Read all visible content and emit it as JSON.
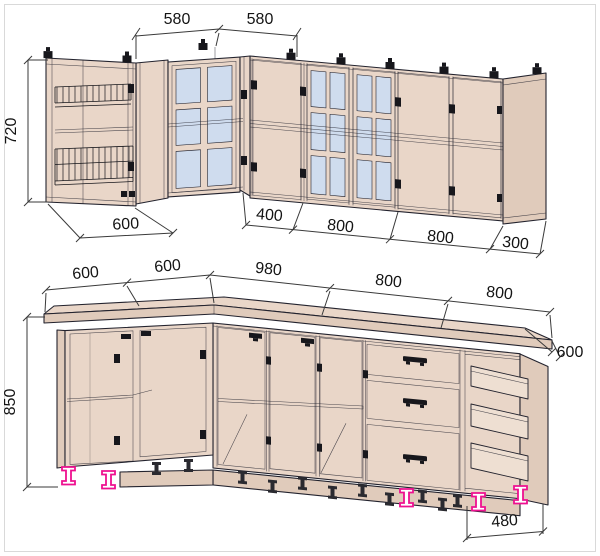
{
  "title": "L-shaped kitchen set dimensional drawing",
  "colors": {
    "background": "#ffffff",
    "cabinet": "#e9d6c8",
    "cabinet_dark": "#e0cbbb",
    "glass": "#cfdcee",
    "box": "#eedfd2",
    "line": "#23232e",
    "dim": "#3a3a3a",
    "text": "#141414",
    "fitting": "#17171c",
    "feet": "#ee1090",
    "frame": "#d9d9d9"
  },
  "dims": {
    "upper_top": [
      "580",
      "580"
    ],
    "upper_height": "720",
    "upper_bottom": [
      "600",
      "400",
      "800",
      "800",
      "300"
    ],
    "lower_top": [
      "600",
      "600",
      "980",
      "800",
      "800"
    ],
    "lower_height": "850",
    "lower_depth": "600",
    "lower_plinth": "480"
  }
}
